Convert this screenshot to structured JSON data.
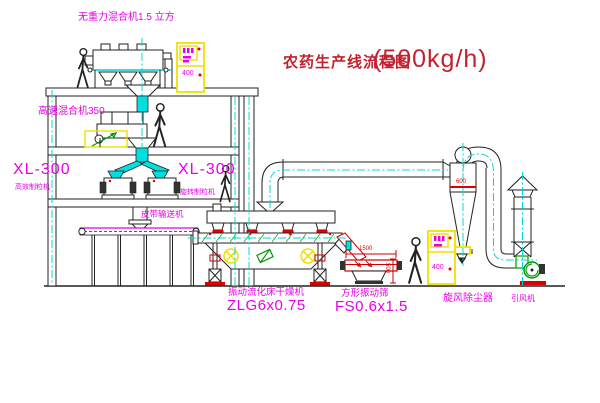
{
  "title": {
    "name": "农药生产线流程图",
    "capacity": "(500kg/h)"
  },
  "equipment": {
    "gravity_free_mixer": {
      "label": "无重力混合机1.5 立方"
    },
    "high_speed_mixer": {
      "label": "高速混合机350"
    },
    "granulator_left": {
      "model": "XL-300",
      "name": "高效制粒机"
    },
    "granulator_right": {
      "model": "XL-300",
      "name": "旋转制粒机"
    },
    "belt_conveyor": {
      "label": "皮带输送机"
    },
    "fluid_bed_dryer": {
      "name": "振动流化床干燥机",
      "model": "ZLG6x0.75"
    },
    "square_sieve": {
      "name": "方形振动筛",
      "model": "FS0.6x1.5"
    },
    "cyclone": {
      "name": "旋风除尘器",
      "dim": "600"
    },
    "fan": {
      "label": "引风机"
    }
  },
  "cabinets": {
    "top": "400",
    "right": "400"
  },
  "dims": {
    "sieve_len": "1500",
    "sieve_h": "500"
  },
  "colors": {
    "label_magenta": "#e800e8",
    "title_red": "#c22230",
    "centerline_cyan": "#00d8d8",
    "cabinet_yellow": "#f0e000",
    "dimension_red": "#dd0000",
    "fan_green": "#009900"
  }
}
